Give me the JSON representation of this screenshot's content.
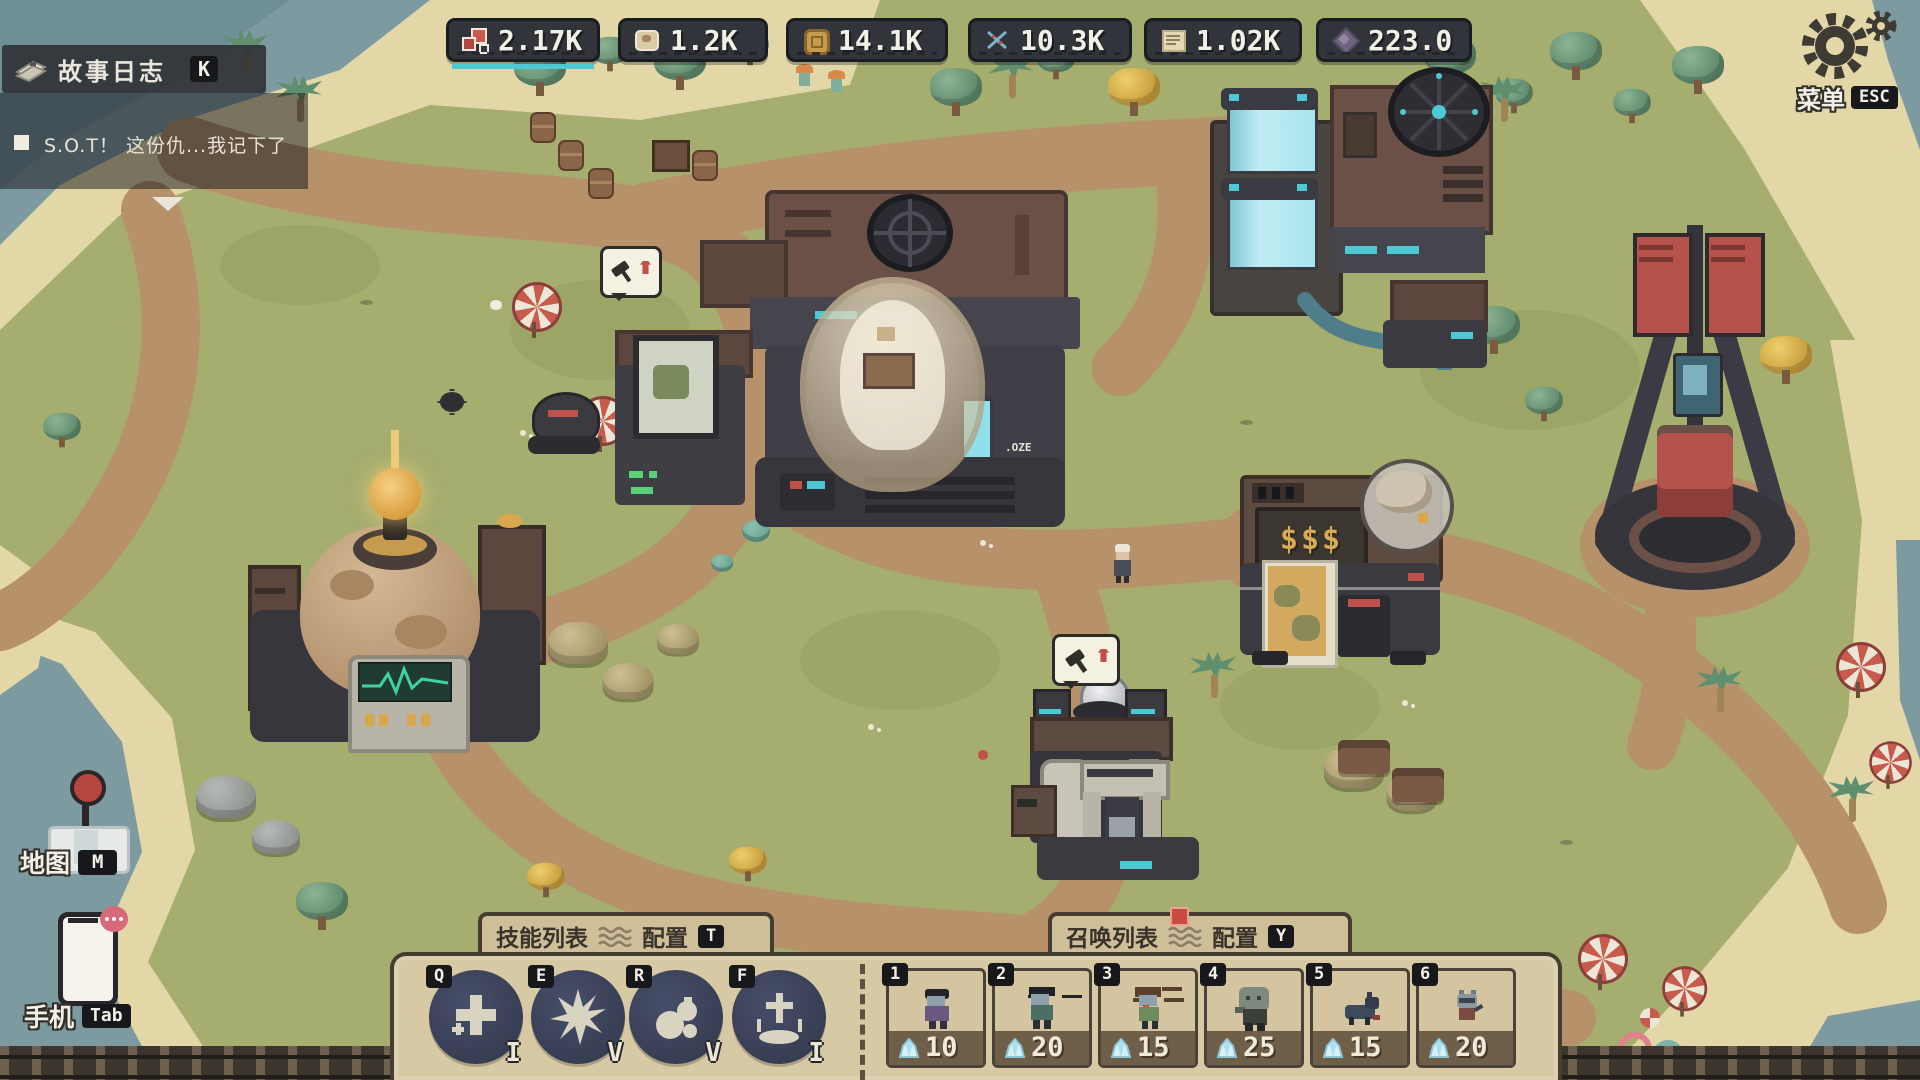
{
  "story_log": {
    "title": "故事日志",
    "key_hint": "K",
    "entry_text": "S.O.T！ 这份仇...我记下了"
  },
  "resource_bar": {
    "items": [
      {
        "icon": "red-blocks-icon",
        "value": "2.17K"
      },
      {
        "icon": "hide-icon",
        "value": "1.2K"
      },
      {
        "icon": "coin-icon",
        "value": "14.1K"
      },
      {
        "icon": "dna-icon",
        "value": "10.3K"
      },
      {
        "icon": "scroll-icon",
        "value": "1.02K"
      },
      {
        "icon": "gem-icon",
        "value": "223.0"
      }
    ],
    "selected_underline_color": "#4fc8d6"
  },
  "menu_button": {
    "label": "菜单",
    "key_hint": "ESC"
  },
  "map_button": {
    "label": "地图",
    "key_hint": "M"
  },
  "phone_button": {
    "label": "手机",
    "key_hint": "Tab"
  },
  "action_bar": {
    "skill_section": {
      "title": "技能列表",
      "config_label": "配置",
      "config_key": "T",
      "slots": [
        {
          "key": "Q",
          "rank": "I",
          "icon": "cross-skill-icon"
        },
        {
          "key": "E",
          "rank": "V",
          "icon": "burst-skill-icon"
        },
        {
          "key": "R",
          "rank": "V",
          "icon": "bomb-skill-icon"
        },
        {
          "key": "F",
          "rank": "I",
          "icon": "totem-skill-icon"
        }
      ]
    },
    "summon_section": {
      "title": "召唤列表",
      "has_notification": true,
      "config_label": "配置",
      "config_key": "Y",
      "slots": [
        {
          "key": "1",
          "cost": "10",
          "icon": "zombie-purple-sprite"
        },
        {
          "key": "2",
          "cost": "20",
          "icon": "zombie-green-sprite"
        },
        {
          "key": "3",
          "cost": "15",
          "icon": "zombie-spiky-sprite"
        },
        {
          "key": "4",
          "cost": "25",
          "icon": "zombie-big-sprite"
        },
        {
          "key": "5",
          "cost": "15",
          "icon": "hound-sprite"
        },
        {
          "key": "6",
          "cost": "20",
          "icon": "cat-sprite"
        }
      ]
    }
  },
  "scene": {
    "command_center_label": ".OZE",
    "shop_sign": "$$$"
  }
}
